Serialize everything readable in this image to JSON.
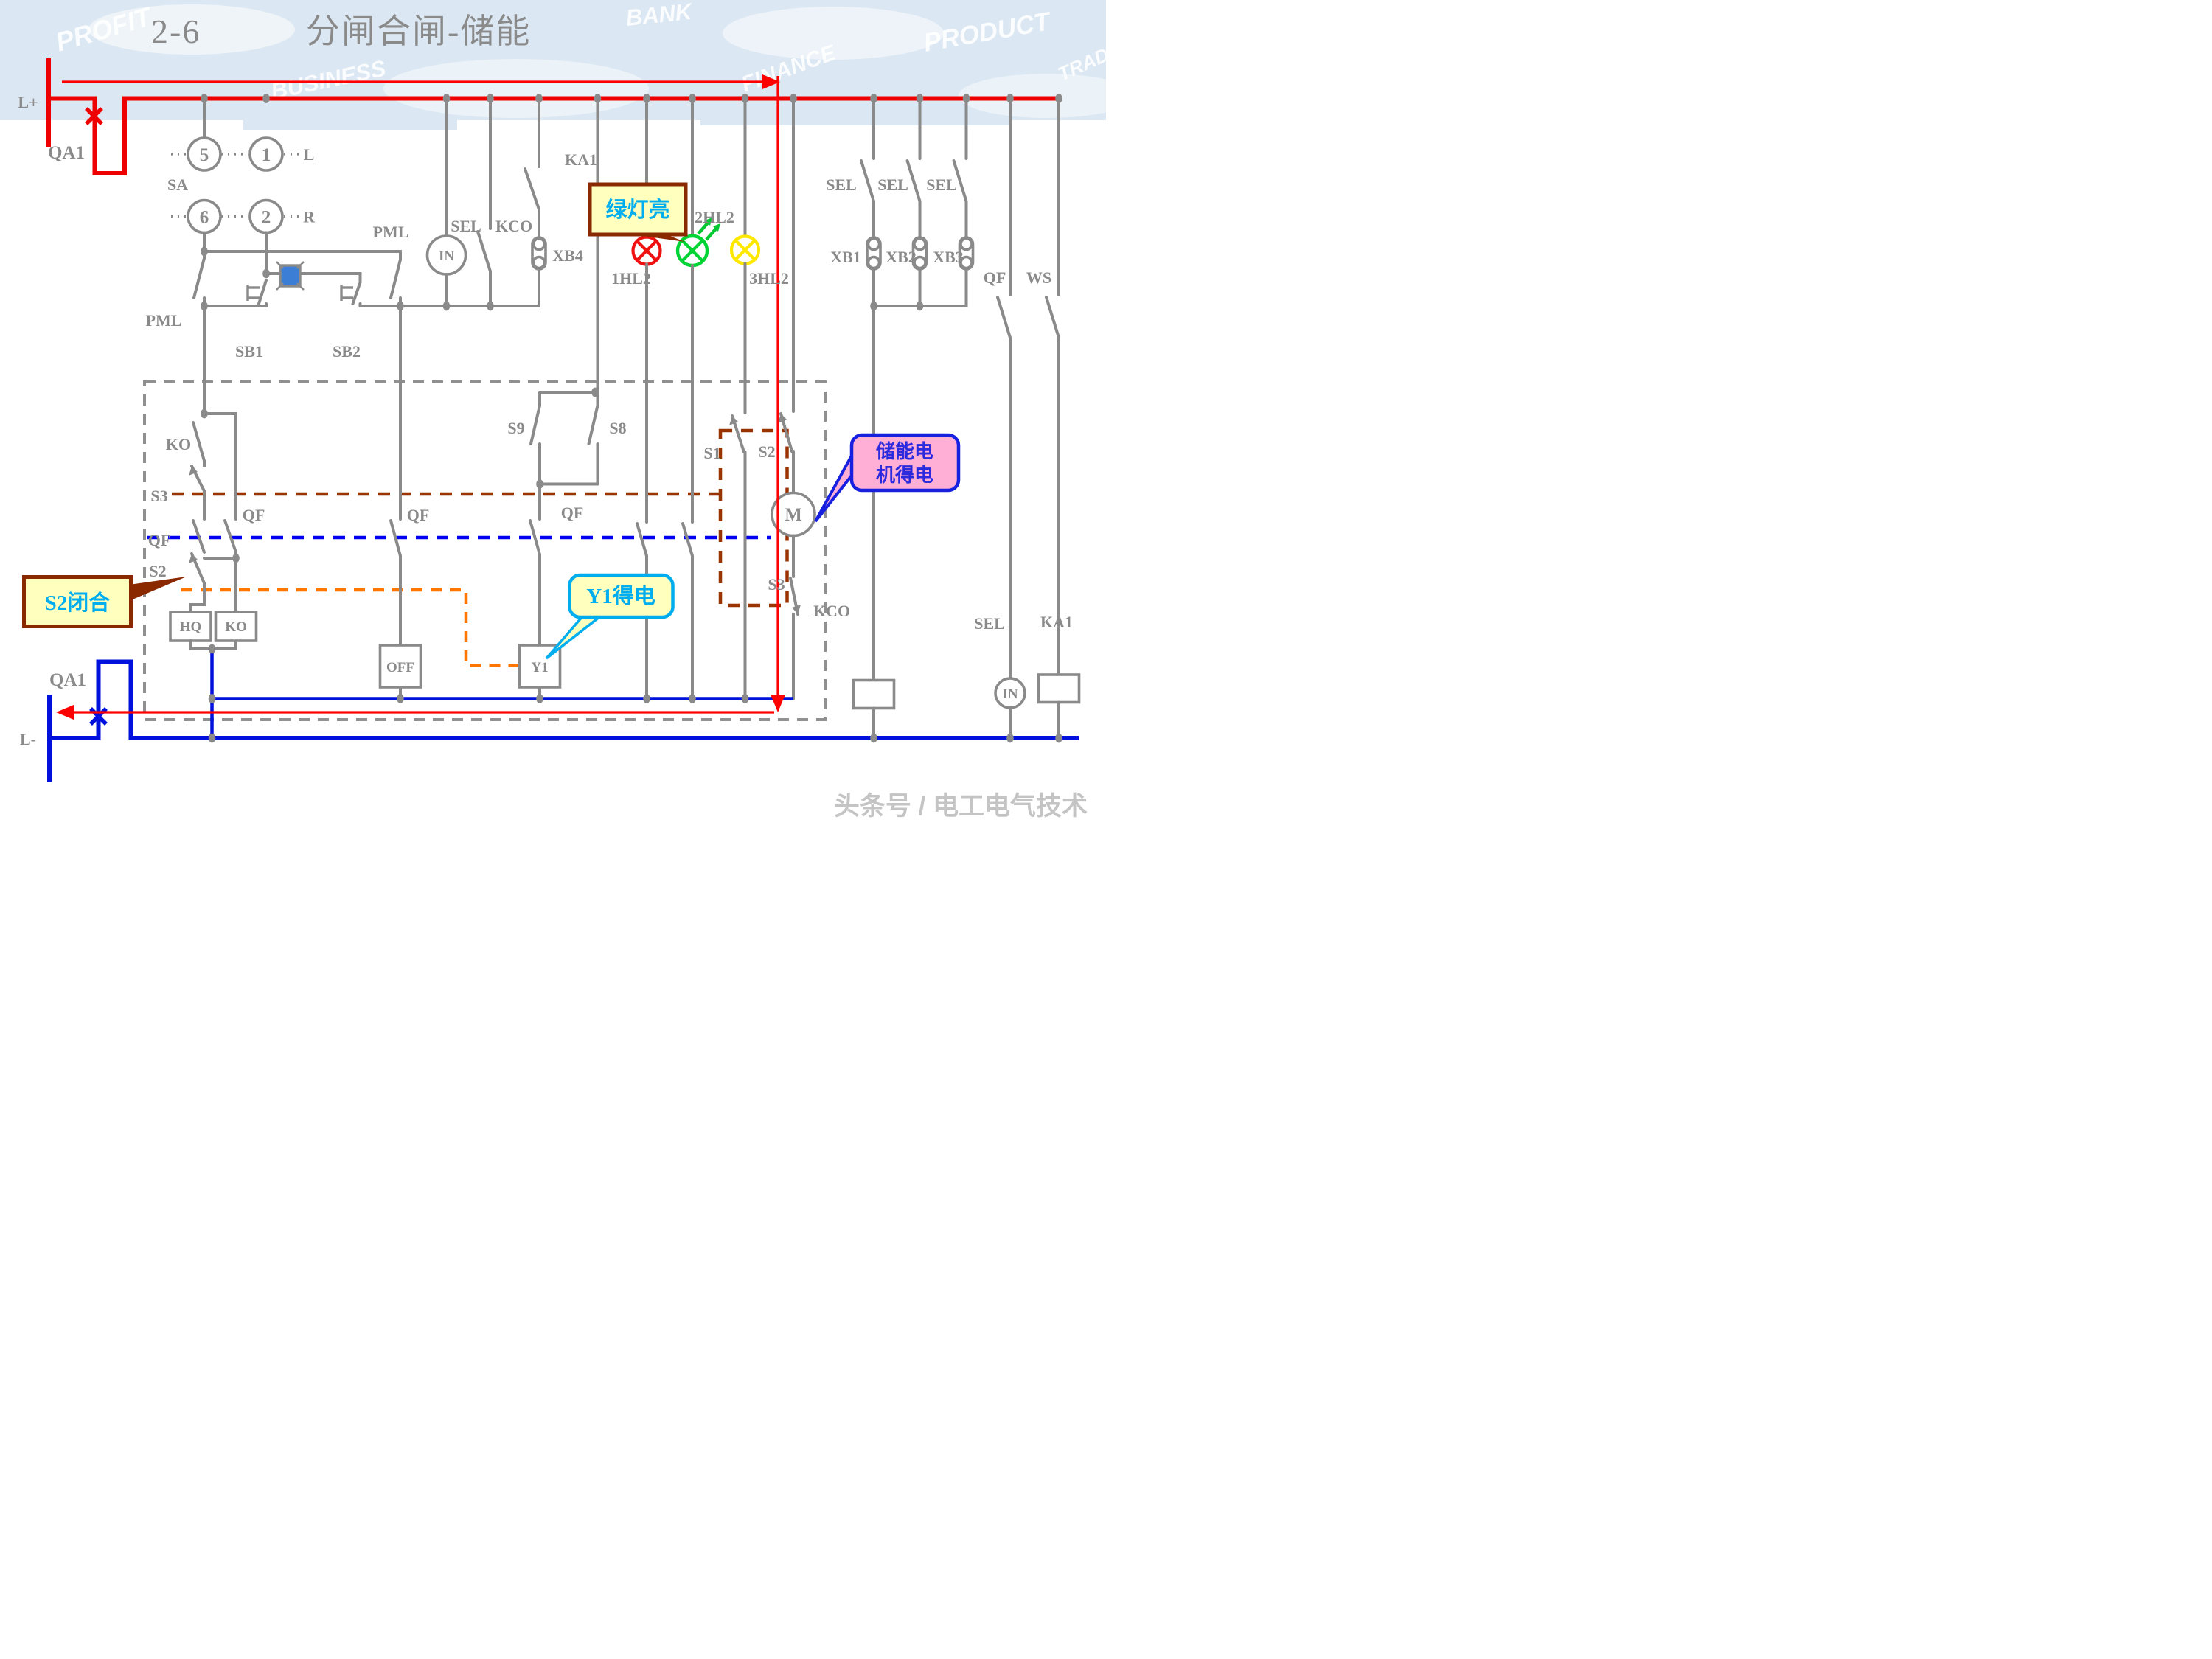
{
  "title": {
    "num": "2-6",
    "main": "分闸合闸-储能"
  },
  "colors": {
    "rail_positive": "#ee0000",
    "rail_negative": "#0011dd",
    "circuit_gray": "#8a8a8a",
    "flow_arrow": "#ff0000",
    "interlock_brown": "#993300",
    "interlock_blue": "#0000ee",
    "interlock_orange": "#ff7700",
    "lamp_red": "#ee1111",
    "lamp_green": "#00d435",
    "lamp_yellow": "#ffe800",
    "callout_yellow_fill": "#ffffbe",
    "callout_pink_fill": "#ffaed6",
    "callout_brown_border": "#8a2800",
    "callout_blue_border": "#1820e0",
    "callout_cyan": "#00aeef",
    "pushbutton_blue": "#3a7fd5",
    "watermark_band": "#dbe7f2"
  },
  "labels": {
    "l_plus": "L+",
    "l_minus": "L-",
    "qa1_top": "QA1",
    "qa1_bottom": "QA1",
    "sa": "SA",
    "n5": "5",
    "n1": "1",
    "n6": "6",
    "n2": "2",
    "dir_l": "L",
    "dir_r": "R",
    "pml_left": "PML",
    "pml_right": "PML",
    "sb1": "SB1",
    "sb2": "SB2",
    "sel_in_top": "SEL",
    "kco_top": "KCO",
    "in_top": "IN",
    "xb4": "XB4",
    "ka1_top": "KA1",
    "hl1": "1HL2",
    "hl2": "2HL2",
    "hl3": "3HL2",
    "sel_a": "SEL",
    "sel_b": "SEL",
    "sel_c": "SEL",
    "xb1": "XB1",
    "xb2": "XB2",
    "xb3": "XB3",
    "qf_right": "QF",
    "ws": "WS",
    "ko_switch": "KO",
    "s3_left": "S3",
    "qf_left": "QF",
    "s2_left": "S2",
    "qf_branch": "QF",
    "hq_coil": "HQ",
    "ko_coil": "KO",
    "qf_off_col": "QF",
    "off_coil": "OFF",
    "s9": "S9",
    "s8": "S8",
    "qf_y1col": "QF",
    "y1_coil": "Y1",
    "s1": "S1",
    "s2_right": "S2",
    "m_motor": "M",
    "s3_right": "S3",
    "kco_coil": "KCO",
    "sel_bottom": "SEL",
    "in_bottom": "IN",
    "ka1_bottom": "KA1"
  },
  "callouts": {
    "green_light": "绿灯亮",
    "motor_line1": "储能电",
    "motor_line2": "机得电",
    "y1": "Y1得电",
    "s2": "S2闭合"
  },
  "watermark": {
    "words": [
      "PROFIT",
      "BUSINESS",
      "BANK",
      "FINANCE",
      "PRODUCT",
      "TRADE"
    ],
    "credit": "头条号 / 电工电气技术"
  }
}
